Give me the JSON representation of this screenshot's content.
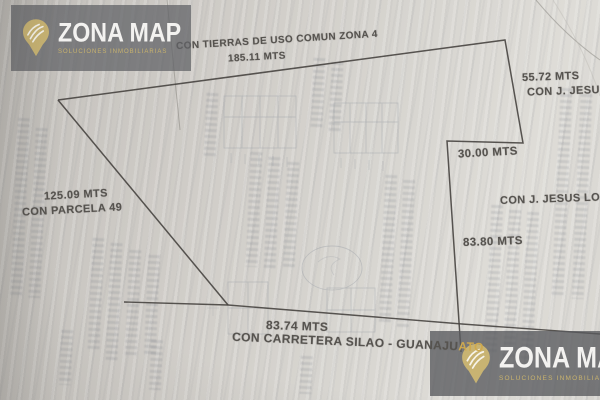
{
  "watermarks": {
    "brand": "ZONA MAP",
    "tagline": "SOLUCIONES INMOBILIARIAS",
    "pin_color": "#c8b372",
    "brand_text_color": "#f3f2f0",
    "tagline_color": "#c9b36d",
    "box_color": "#616367"
  },
  "parcel": {
    "line_color": "#474440",
    "top": {
      "neighbor": "CON TIERRAS DE USO COMUN ZONA 4",
      "length": "185.11 MTS"
    },
    "right_upper": {
      "length": "55.72 MTS",
      "neighbor": "CON J. JESUS L"
    },
    "step": {
      "length": "30.00 MTS"
    },
    "right_lower": {
      "neighbor": "CON J. JESUS LOZA",
      "length": "83.80 MTS"
    },
    "left": {
      "length": "125.09 MTS",
      "neighbor": "CON PARCELA 49"
    },
    "bottom": {
      "length": "83.74 MTS",
      "road_label": "CON CARRETERA SILAO - GUANAJU",
      "road_label_overlap": "ATO"
    }
  }
}
